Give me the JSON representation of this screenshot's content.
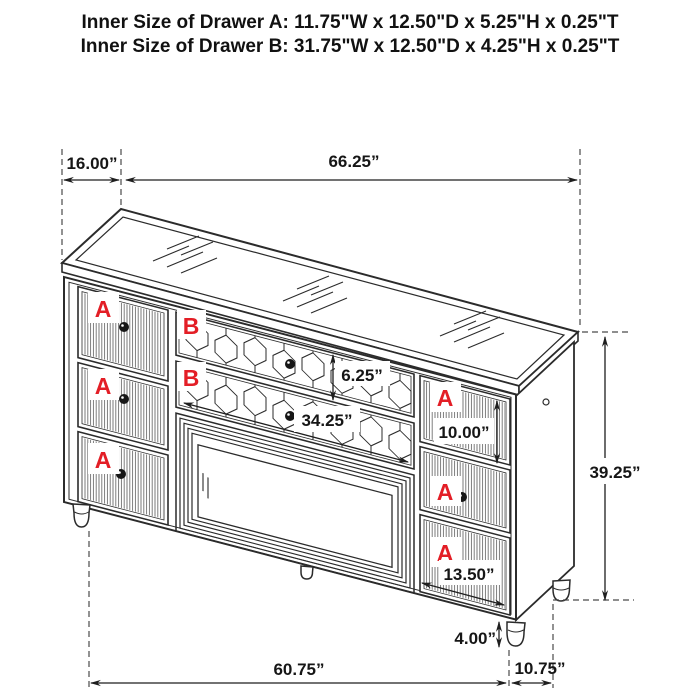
{
  "title": {
    "line1": "Inner Size of Drawer A: 11.75\"W x 12.50\"D x 5.25\"H x 0.25\"T",
    "line2": "Inner Size of Drawer B: 31.75\"W x 12.50\"D x 4.25\"H x 0.25\"T"
  },
  "drawer_labels": {
    "a": "A",
    "b": "B"
  },
  "dimensions": {
    "top_depth": "16.00”",
    "top_width": "66.25”",
    "drawer_b_height": "6.25”",
    "drawer_b_width": "34.25”",
    "drawer_a_right_height": "10.00”",
    "drawer_a_bottom_width": "13.50”",
    "overall_height": "39.25”",
    "leg_height": "4.00”",
    "bottom_width": "60.75”",
    "bottom_depth": "10.75”"
  },
  "colors": {
    "line": "#2b2b2b",
    "label_red": "#e31e26",
    "background": "#ffffff"
  }
}
